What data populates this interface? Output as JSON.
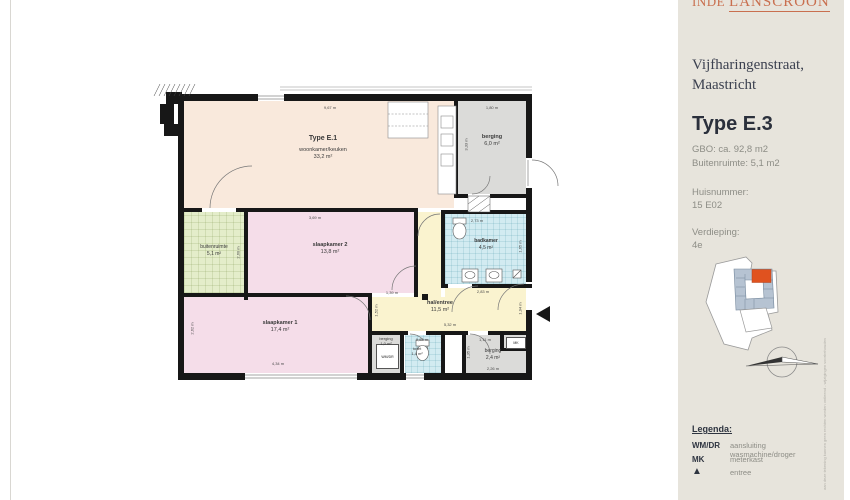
{
  "colors": {
    "logo_accent": "#c96f4f",
    "unit_highlight": "#e0521f",
    "building_block": "#b6c3d2",
    "sidebar_bg": "#e7e4dc"
  },
  "sidebar": {
    "logo": {
      "part1": "INDE",
      "part2": "LANSCROON"
    },
    "address": [
      "Vijfharingenstraat,",
      "Maastricht"
    ],
    "type_title": "Type E.3",
    "spec_lines": [
      "GBO: ca. 92,8 m2",
      "Buitenruimte: 5,1 m2"
    ],
    "huisnummer_label": "Huisnummer:",
    "huisnummer_value": "15 E02",
    "verdieping_label": "Verdieping:",
    "verdieping_value": "4e",
    "legend": {
      "title": "Legenda:",
      "items": [
        {
          "symbol": "WM/DR",
          "label": "aansluiting wasmachine/droger"
        },
        {
          "symbol": "MK",
          "label": "meterkast"
        },
        {
          "symbol": "▲",
          "label": "entree"
        }
      ]
    },
    "disclaimer_vertical": "aan deze tekening kunnen geen rechten worden ontleend - wijzigingen voorbehouden"
  },
  "plan": {
    "unit_label": "Type E.1",
    "rooms": {
      "woonkamer": {
        "name": "woonkamer/keuken",
        "area": "33,2 m²"
      },
      "berging_groot": {
        "name": "berging",
        "area": "6,0 m²"
      },
      "buitenruimte": {
        "name": "buitenruimte",
        "area": "5,1 m²"
      },
      "slaapkamer2": {
        "name": "slaapkamer 2",
        "area": "13,8 m²"
      },
      "badkamer": {
        "name": "badkamer",
        "area": "4,5 m²"
      },
      "hal": {
        "name": "hal/entree",
        "area": "11,5 m²"
      },
      "slaapkamer1": {
        "name": "slaapkamer 1",
        "area": "17,4 m²"
      },
      "berging_klein": {
        "name": "berging",
        "area": "1,0 m²"
      },
      "toilet": {
        "name": "toilet",
        "area": "1,4 m²"
      },
      "berging_2": {
        "name": "berging",
        "area": "2,4 m²"
      }
    },
    "fixtures": {
      "wasmachine": "WM/DR",
      "meterkast": "MK"
    },
    "dims": {
      "woonkamer_top": "9,67 m",
      "berging_top": "1,80 m",
      "berging_left": "3,33 m",
      "slaapkamer2_top": "3,69 m",
      "buitenruimte_right": "2,60 m",
      "badkamer_top": "2,73 m",
      "badkamer_right": "1,65 m",
      "badkamer_bottom": "2,83 m",
      "hal_top_left": "1,39 m",
      "hal_bottom": "5,32 m",
      "hal_left": "1,52 m",
      "hal_right": "1,94 m",
      "toilet_top": "0,83 m",
      "berging2_top": "1,11 m",
      "berging2_left": "1,35 m",
      "berging2_bottom": "2,26 m",
      "slaapkamer1_bottom": "4,34 m",
      "slaapkamer1_left": "2,62 m"
    }
  }
}
